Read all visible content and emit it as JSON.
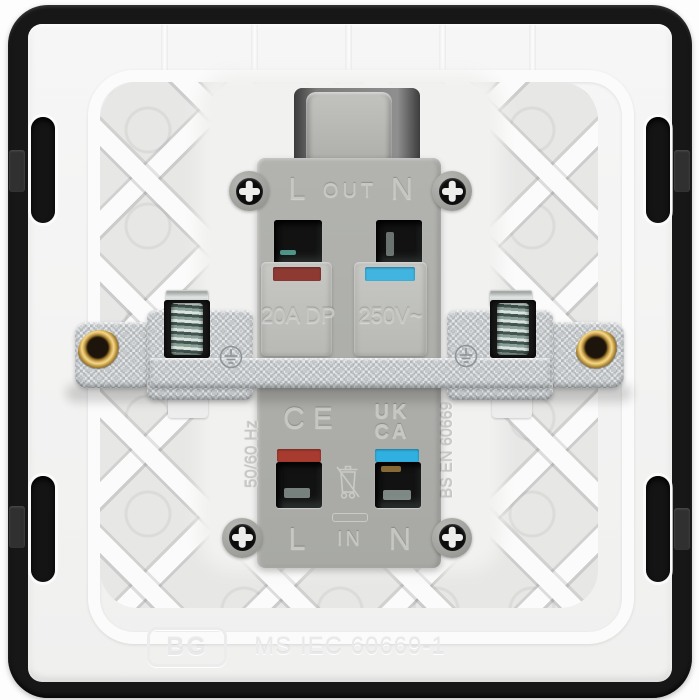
{
  "image_kind": "product-photo-rear-of-20A-double-pole-switch",
  "labels": {
    "top_l": "L",
    "top_mid": "OUT",
    "top_n": "N",
    "bottom_l": "L",
    "bottom_mid": "IN",
    "bottom_n": "N",
    "rating_current": "20A DP",
    "rating_voltage": "250V~",
    "frequency": "50/60 Hz",
    "ce": "CE",
    "ukca_top": "UK",
    "ukca_bottom": "CA",
    "standard_side": "BS EN 60669",
    "brand": "BG",
    "standard_bottom": "MS IEC 60669-1"
  },
  "colors": {
    "frame_black": "#171717",
    "plate_white": "#f3f3f3",
    "body_grey": "#b0b1ad",
    "metal_strap": "#c6cacd",
    "brass": "#d4ab55",
    "live_strip_top": "#8e3a33",
    "live_strip_bottom": "#a83b2f",
    "neutral_strip_top": "#41b4e0",
    "neutral_strip_bottom": "#2fb0e0"
  },
  "icons": {
    "earth_symbol": "earth-ground-in-circle (stamped, x2)",
    "weee_symbol": "crossed-out-wheelie-bin",
    "phillips_screw": "cross-head-screw (x4)",
    "brass_insert": "threaded-brass-ring (x2)"
  }
}
